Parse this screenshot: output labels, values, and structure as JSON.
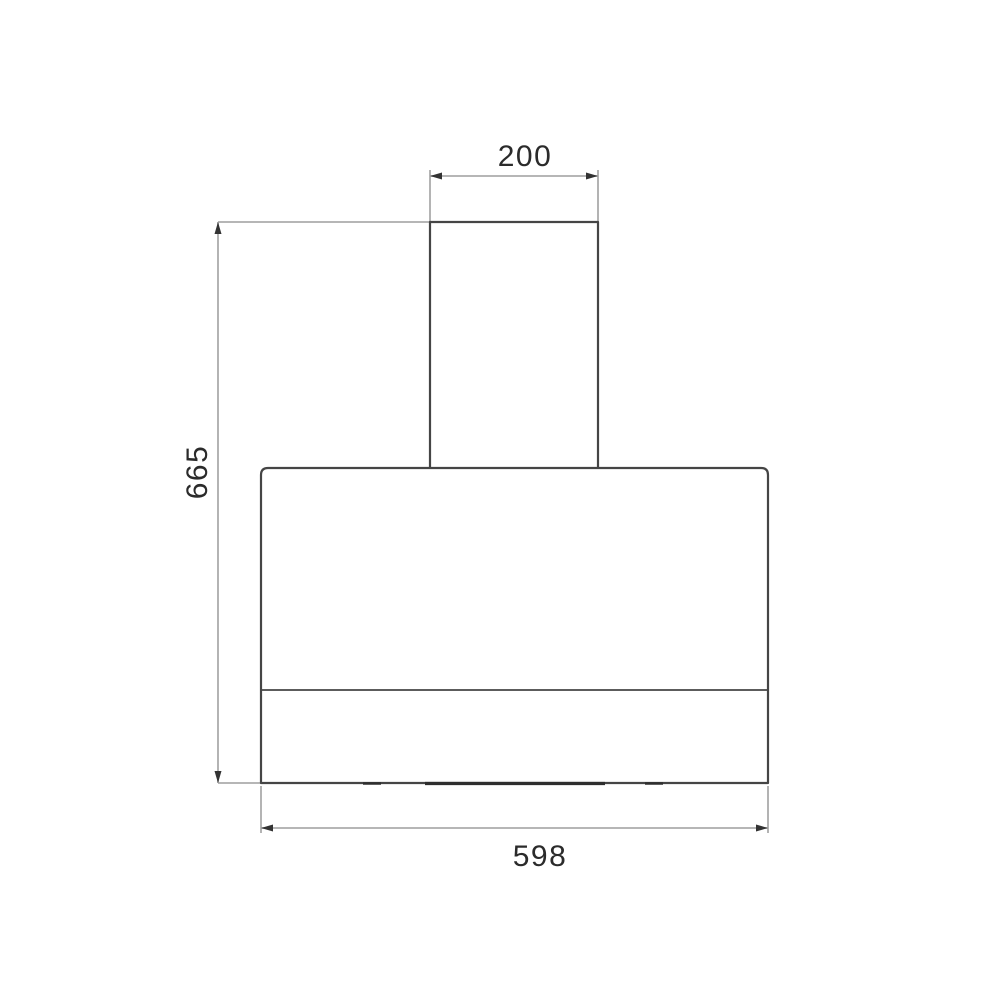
{
  "page": {
    "background_color": "#ffffff",
    "content": "technical dimension drawing of a wall-mounted cooker hood, front view"
  },
  "diagram": {
    "colors": {
      "product_outline": "#454545",
      "dimension_line": "#ababab",
      "arrowhead": "#333333",
      "label_text": "#2b2b2b"
    },
    "dimensions": {
      "chimney_width": {
        "value": "200",
        "position": "top"
      },
      "overall_height": {
        "value": "665",
        "position": "left"
      },
      "body_width": {
        "value": "598",
        "position": "bottom"
      }
    }
  }
}
